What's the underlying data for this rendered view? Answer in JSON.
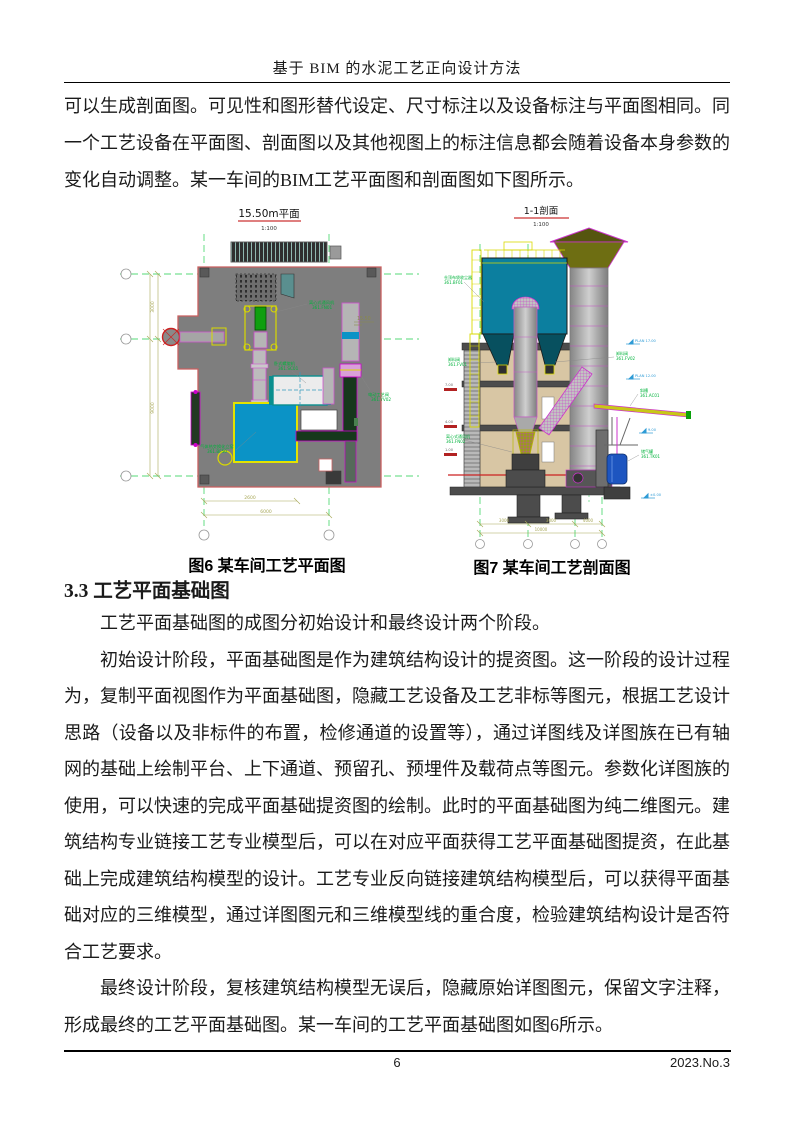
{
  "header": {
    "title": "基于 BIM 的水泥工艺正向设计方法"
  },
  "article": {
    "para_top": "可以生成剖面图。可见性和图形替代设定、尺寸标注以及设备标注与平面图相同。同一个工艺设备在平面图、剖面图以及其他视图上的标注信息都会随着设备本身参数的变化自动调整。某一车间的BIM工艺平面图和剖面图如下图所示。",
    "section": {
      "heading": "3.3 工艺平面基础图",
      "para_intro": "工艺平面基础图的成图分初始设计和最终设计两个阶段。",
      "para_initial": "初始设计阶段，平面基础图是作为建筑结构设计的提资图。这一阶段的设计过程为，复制平面视图作为平面基础图，隐藏工艺设备及工艺非标等图元，根据工艺设计思路（设备以及非标件的布置，检修通道的设置等），通过详图线及详图族在已有轴网的基础上绘制平台、上下通道、预留孔、预埋件及载荷点等图元。参数化详图族的使用，可以快速的完成平面基础提资图的绘制。此时的平面基础图为纯二维图元。建筑结构专业链接工艺专业模型后，可以在对应平面获得工艺平面基础图提资，在此基础上完成建筑结构模型的设计。工艺专业反向链接建筑结构模型后，可以获得平面基础对应的三维模型，通过详图图元和三维模型线的重合度，检验建筑结构设计是否符合工艺要求。",
      "para_final": "最终设计阶段，复核建筑结构模型无误后，隐藏原始详图图元，保留文字注释，形成最终的工艺平面基础图。某一车间的工艺平面基础图如图6所示。"
    }
  },
  "figures": {
    "fig6": {
      "view_title": "15.50m平面",
      "view_scale": "1:100",
      "caption": "图6 某车间工艺平面图",
      "labels": {
        "fan": "离心式通风机",
        "fan_code": "361.FN01",
        "screw": "卧式螺旋机",
        "screw_code": "361.SC01",
        "valve": "电动工艺阀",
        "valve_code": "361.YV02",
        "kiln": "气体热交换化立窑",
        "kiln_code": "361.BF50",
        "elev": "15.50"
      },
      "dims": {
        "v1": "3000",
        "v2": "9000",
        "h1": "2600",
        "h2": "6000"
      }
    },
    "fig7": {
      "view_title": "1-1剖面",
      "view_scale": "1:100",
      "caption": "图7 某车间工艺剖面图",
      "labels": {
        "duster": "仓顶布袋收尘器",
        "duster_code": "361.BF01",
        "valve_left": "卸料阀",
        "valve_left_code": "361.FV01",
        "valve_right": "卸料阀",
        "valve_right_code": "361.FV02",
        "chute": "斜槽",
        "chute_code": "361.AC01",
        "fan": "离心式通风机",
        "fan_code": "361.FN02",
        "tank": "储气罐",
        "tank_code": "361.TK01",
        "plan_a": "PLAN 17.00",
        "plan_b": "PLAN 12.00",
        "elev_a": "9.00",
        "elev_b": "±0.00",
        "elev_l1": "7.00",
        "elev_l2": "4.00",
        "elev_l3": "1.00"
      },
      "dims": {
        "d1": "3000",
        "d2": "3000",
        "d3": "4000",
        "total": "10000"
      }
    }
  },
  "footer": {
    "page_number": "6",
    "issue": "2023.No.3"
  },
  "colors": {
    "grid_green": "#55d977",
    "drawing_red": "#c95f5f",
    "equipment_cyan": "#0b93c6",
    "filter_teal": "#0c7f9f",
    "magenta": "#cc33cc",
    "dim_olive": "#a8a858",
    "label_green": "#00b33c",
    "tank_blue": "#1d55c0"
  }
}
